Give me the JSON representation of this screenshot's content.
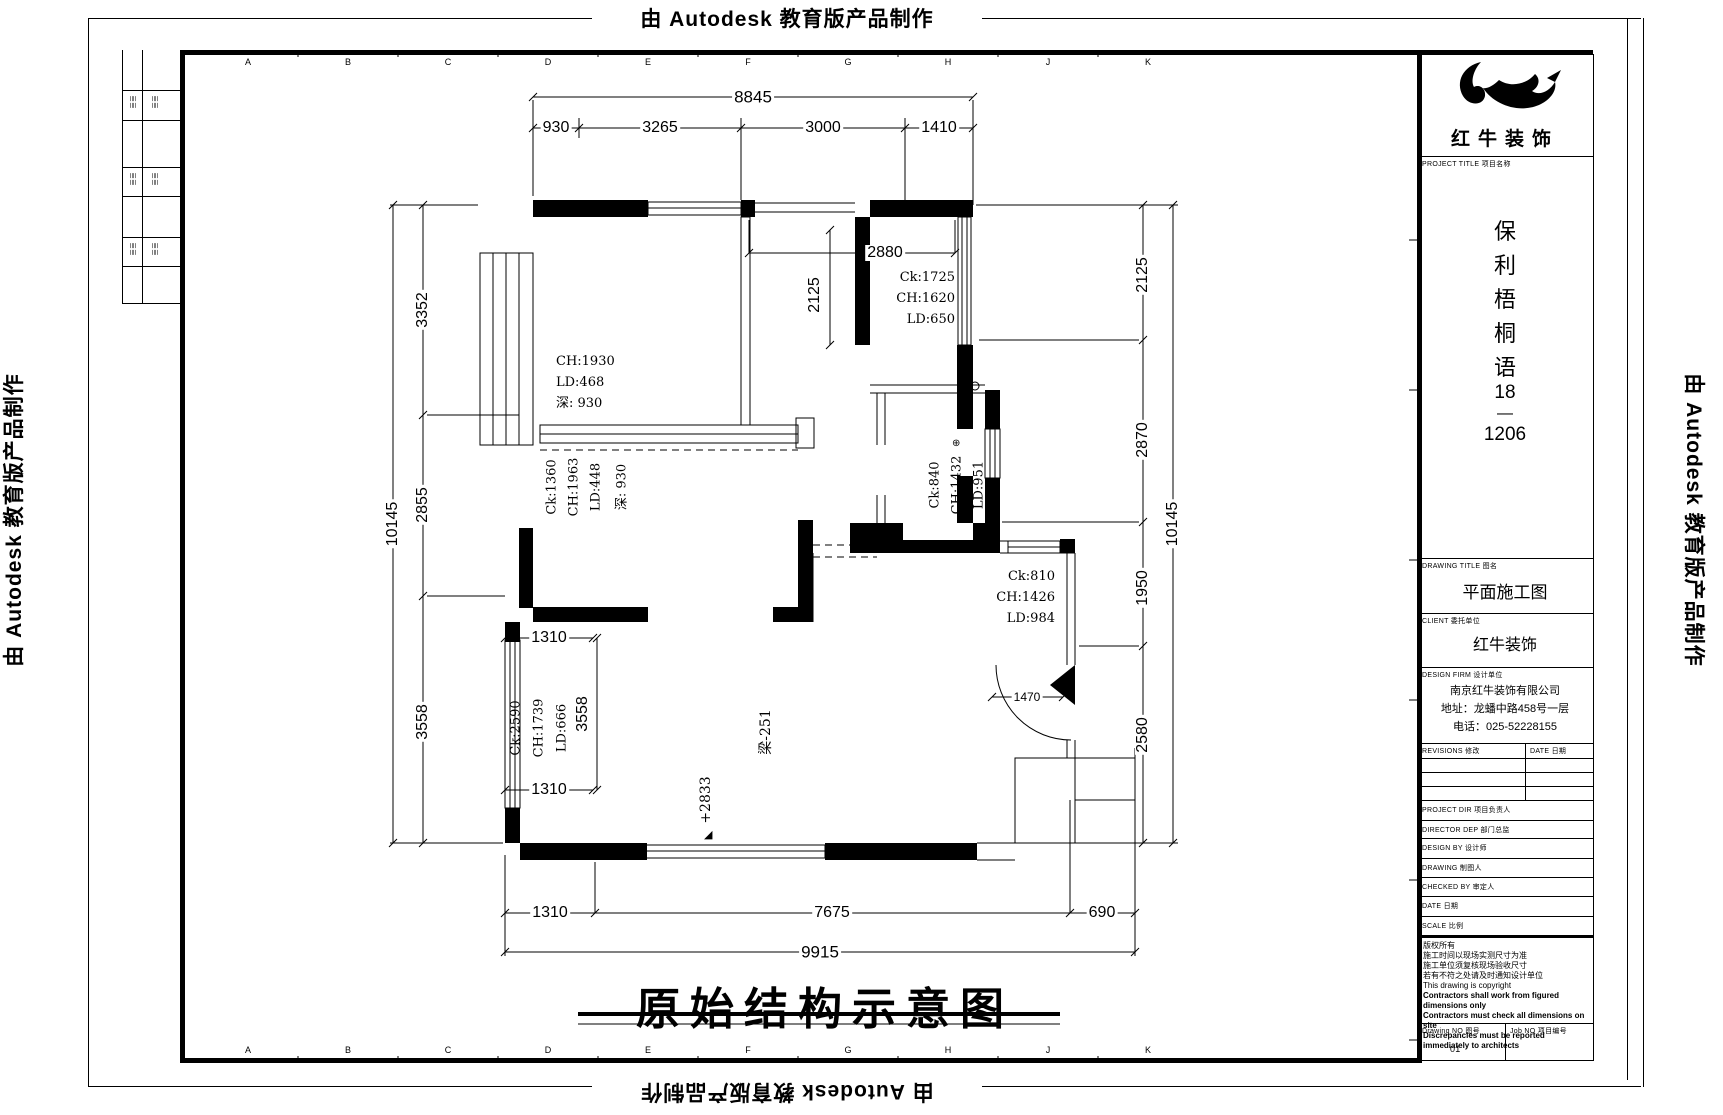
{
  "page": {
    "autodesk_note": "由 Autodesk 教育版产品制作"
  },
  "ruler_letters": [
    "A",
    "B",
    "C",
    "D",
    "E",
    "F",
    "G",
    "H",
    "J",
    "K"
  ],
  "legend_strip": {
    "mark": "≣≣"
  },
  "title_block": {
    "brand": "红牛装饰",
    "project_title_label": "PROJECT TITLE 项目名称",
    "project_name": [
      "保",
      "利",
      "梧",
      "桐",
      "语",
      "18",
      "—",
      "1206"
    ],
    "drawing_title_label": "DRAWING TITLE 图名",
    "drawing_title": "平面施工图",
    "client_label": "CLIENT 委托单位",
    "client": "红牛装饰",
    "firm_label": "DESIGN FIRM 设计单位",
    "firm_lines": [
      "南京红牛装饰有限公司",
      "地址：龙蟠中路458号一层",
      "电话：025-52228155"
    ],
    "revisions_label": "REVISIONS 修改",
    "date_col_label": "DATE 日期",
    "staff_rows": [
      "PROJECT DIR 项目负责人",
      "DIRECTOR DEP 部门总监",
      "DESIGN BY 设计师",
      "DRAWING 制图人",
      "CHECKED BY 审定人",
      "DATE 日期",
      "SCALE 比例"
    ],
    "notes": [
      "版权所有",
      "施工时间以现场实测尺寸为准",
      "施工单位须复核现场验收尺寸",
      "若有不符之处请及时通知设计单位",
      "This drawing is copyright",
      "Contractors shall work from figured dimensions only",
      "Contractors must check all dimensions on site",
      "Discrepancies must be reported immediately to architects"
    ],
    "drawing_no_label": "Drawing NO 图号",
    "job_no_label": "Job NO 项目编号",
    "drawing_no": "01",
    "job_no": ""
  },
  "plan": {
    "title": "原始结构示意图",
    "dims": {
      "top_overall": "8845",
      "top_segs": [
        "930",
        "3265",
        "3000",
        "1410"
      ],
      "left_overall": "10145",
      "left_segs": [
        "3352",
        "2855",
        "3558"
      ],
      "right_overall": "10145",
      "right_segs": [
        "2125",
        "2870",
        "1950",
        "2580"
      ],
      "bottom_overall": "9915",
      "bottom_segs": [
        "1310",
        "7675",
        "690"
      ],
      "inner_2880": "2880",
      "inner_2125": "2125",
      "inner_1470": "1470",
      "left_1310_top": "1310",
      "left_1310_bottom": "1310",
      "left_3558": "3558",
      "beam": "梁-251",
      "level": "+2833"
    },
    "rooms": {
      "bedroom": [
        "CH:1930",
        "LD:468",
        "深: 930"
      ],
      "bedroom2_rot": [
        "Ck:1360",
        "CH:1963",
        "LD:448",
        "深: 930"
      ],
      "shaft": [
        "Ck:1725",
        "CH:1620",
        "LD:650"
      ],
      "bath_rot": [
        "Ck:840",
        "CH:1432",
        "LD:951"
      ],
      "entry": [
        "Ck:810",
        "CH:1426",
        "LD:984"
      ],
      "left_rot": [
        "Ck:2590",
        "CH:1739",
        "LD:666"
      ]
    }
  }
}
